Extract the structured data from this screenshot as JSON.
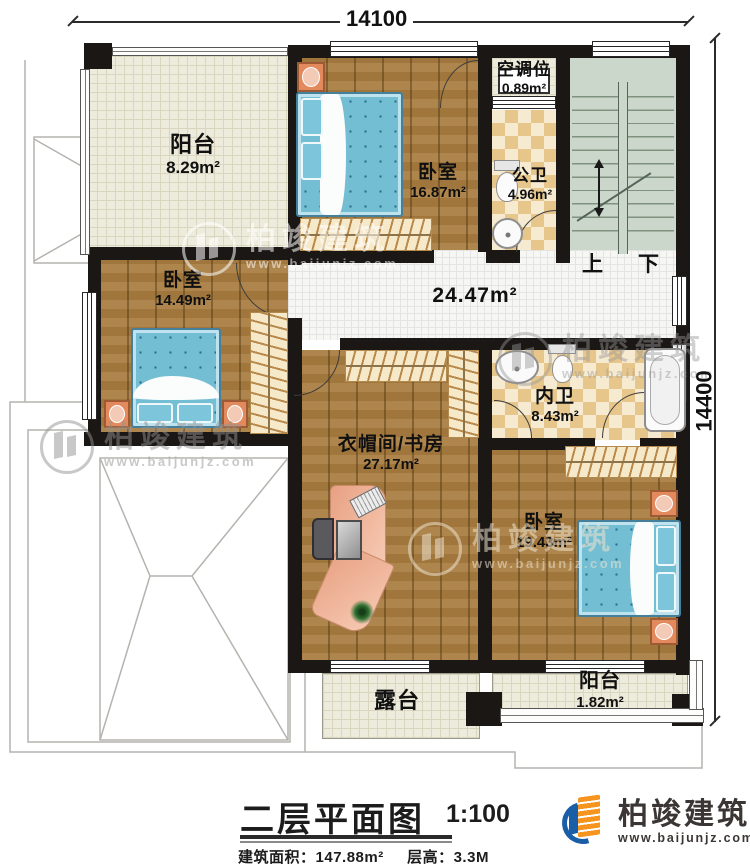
{
  "dimensions": {
    "top": "14100",
    "right": "14400"
  },
  "rooms": {
    "balcony_tl": {
      "name": "阳台",
      "area": "8.29m²"
    },
    "bedroom_top": {
      "name": "卧室",
      "area": "16.87m²"
    },
    "ac": {
      "name": "空调位",
      "area": "0.89m²"
    },
    "public_bath": {
      "name": "公卫",
      "area": "4.96m²"
    },
    "hall": {
      "area": "24.47m²"
    },
    "bedroom_left": {
      "name": "卧室",
      "area": "14.49m²"
    },
    "study": {
      "name": "衣帽间/书房",
      "area": "27.17m²"
    },
    "private_bath": {
      "name": "内卫",
      "area": "8.43m²"
    },
    "bedroom_br": {
      "name": "卧室",
      "area": "19.43m²"
    },
    "balcony_br": {
      "name": "阳台",
      "area": "1.82m²"
    },
    "terrace": {
      "name": "露台"
    }
  },
  "stairs": {
    "up": "上",
    "down": "下"
  },
  "titleblock": {
    "title": "二层平面图",
    "scale": "1:100",
    "area_label": "建筑面积：",
    "area_value": "147.88m²",
    "floor_height_label": "层高：",
    "floor_height_value": "3.3M"
  },
  "brand": {
    "name": "柏竣建筑",
    "url": "www.baijunjz.com"
  },
  "colors": {
    "wall": "#1b1714",
    "wood": "#a87c3f",
    "tile_check": "#e7c68b",
    "stair": "#ccd7cc",
    "brand_blue": "#1b5ea8",
    "brand_orange": "#f7941d"
  }
}
